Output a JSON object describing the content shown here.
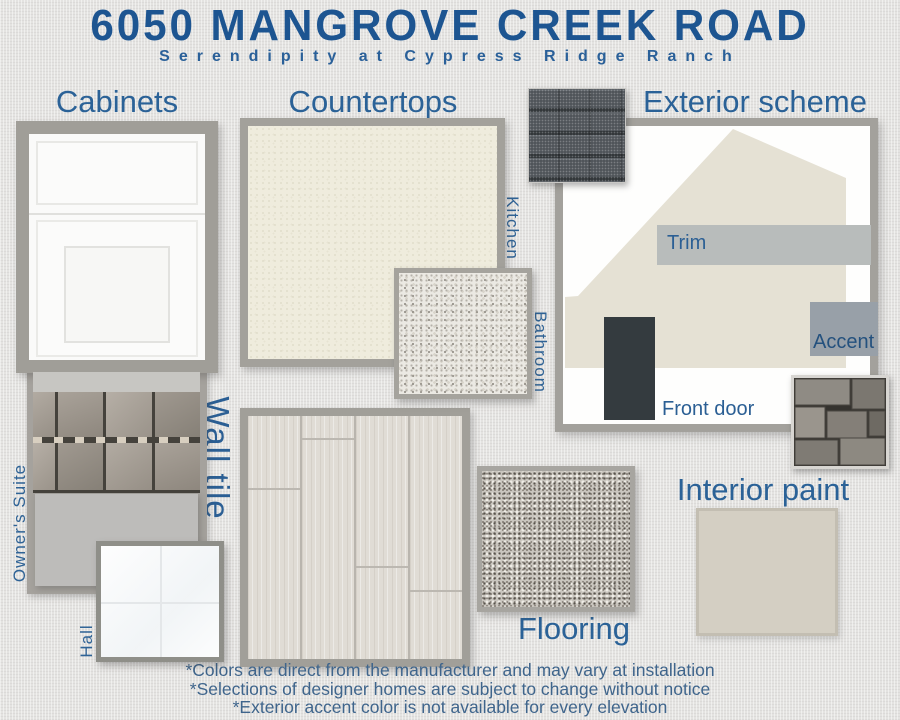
{
  "header": {
    "title": "6050 MANGROVE CREEK ROAD",
    "subtitle": "Serendipity at Cypress Ridge Ranch"
  },
  "sections": {
    "cabinets": {
      "heading": "Cabinets"
    },
    "countertops": {
      "heading": "Countertops",
      "kitchen_label": "Kitchen",
      "bathroom_label": "Bathroom"
    },
    "exterior": {
      "heading": "Exterior scheme",
      "trim_label": "Trim",
      "accent_label": "Accent",
      "front_door_label": "Front door"
    },
    "wall_tile": {
      "heading": "Wall tile",
      "owners_suite_label": "Owner's Suite",
      "hall_label": "Hall"
    },
    "flooring": {
      "heading": "Flooring"
    },
    "interior_paint": {
      "heading": "Interior paint"
    }
  },
  "footer": {
    "notes": [
      "*Colors are direct from the manufacturer and may vary at installation",
      "*Selections of designer homes are subject to change without notice",
      "*Exterior accent color is not available for every elevation"
    ]
  },
  "colors": {
    "title_blue": "#1d5591",
    "heading_blue": "#2b6297",
    "label_blue": "#2f6396",
    "footer_blue": "#3f658c",
    "frame_gray": "#a3a19b",
    "house_beige": "#e5e1d4",
    "trim_gray": "#b8bcbb",
    "accent_gray": "#98a0a8",
    "door_charcoal": "#343b3f",
    "interior_paint": "#d4cfc3"
  }
}
